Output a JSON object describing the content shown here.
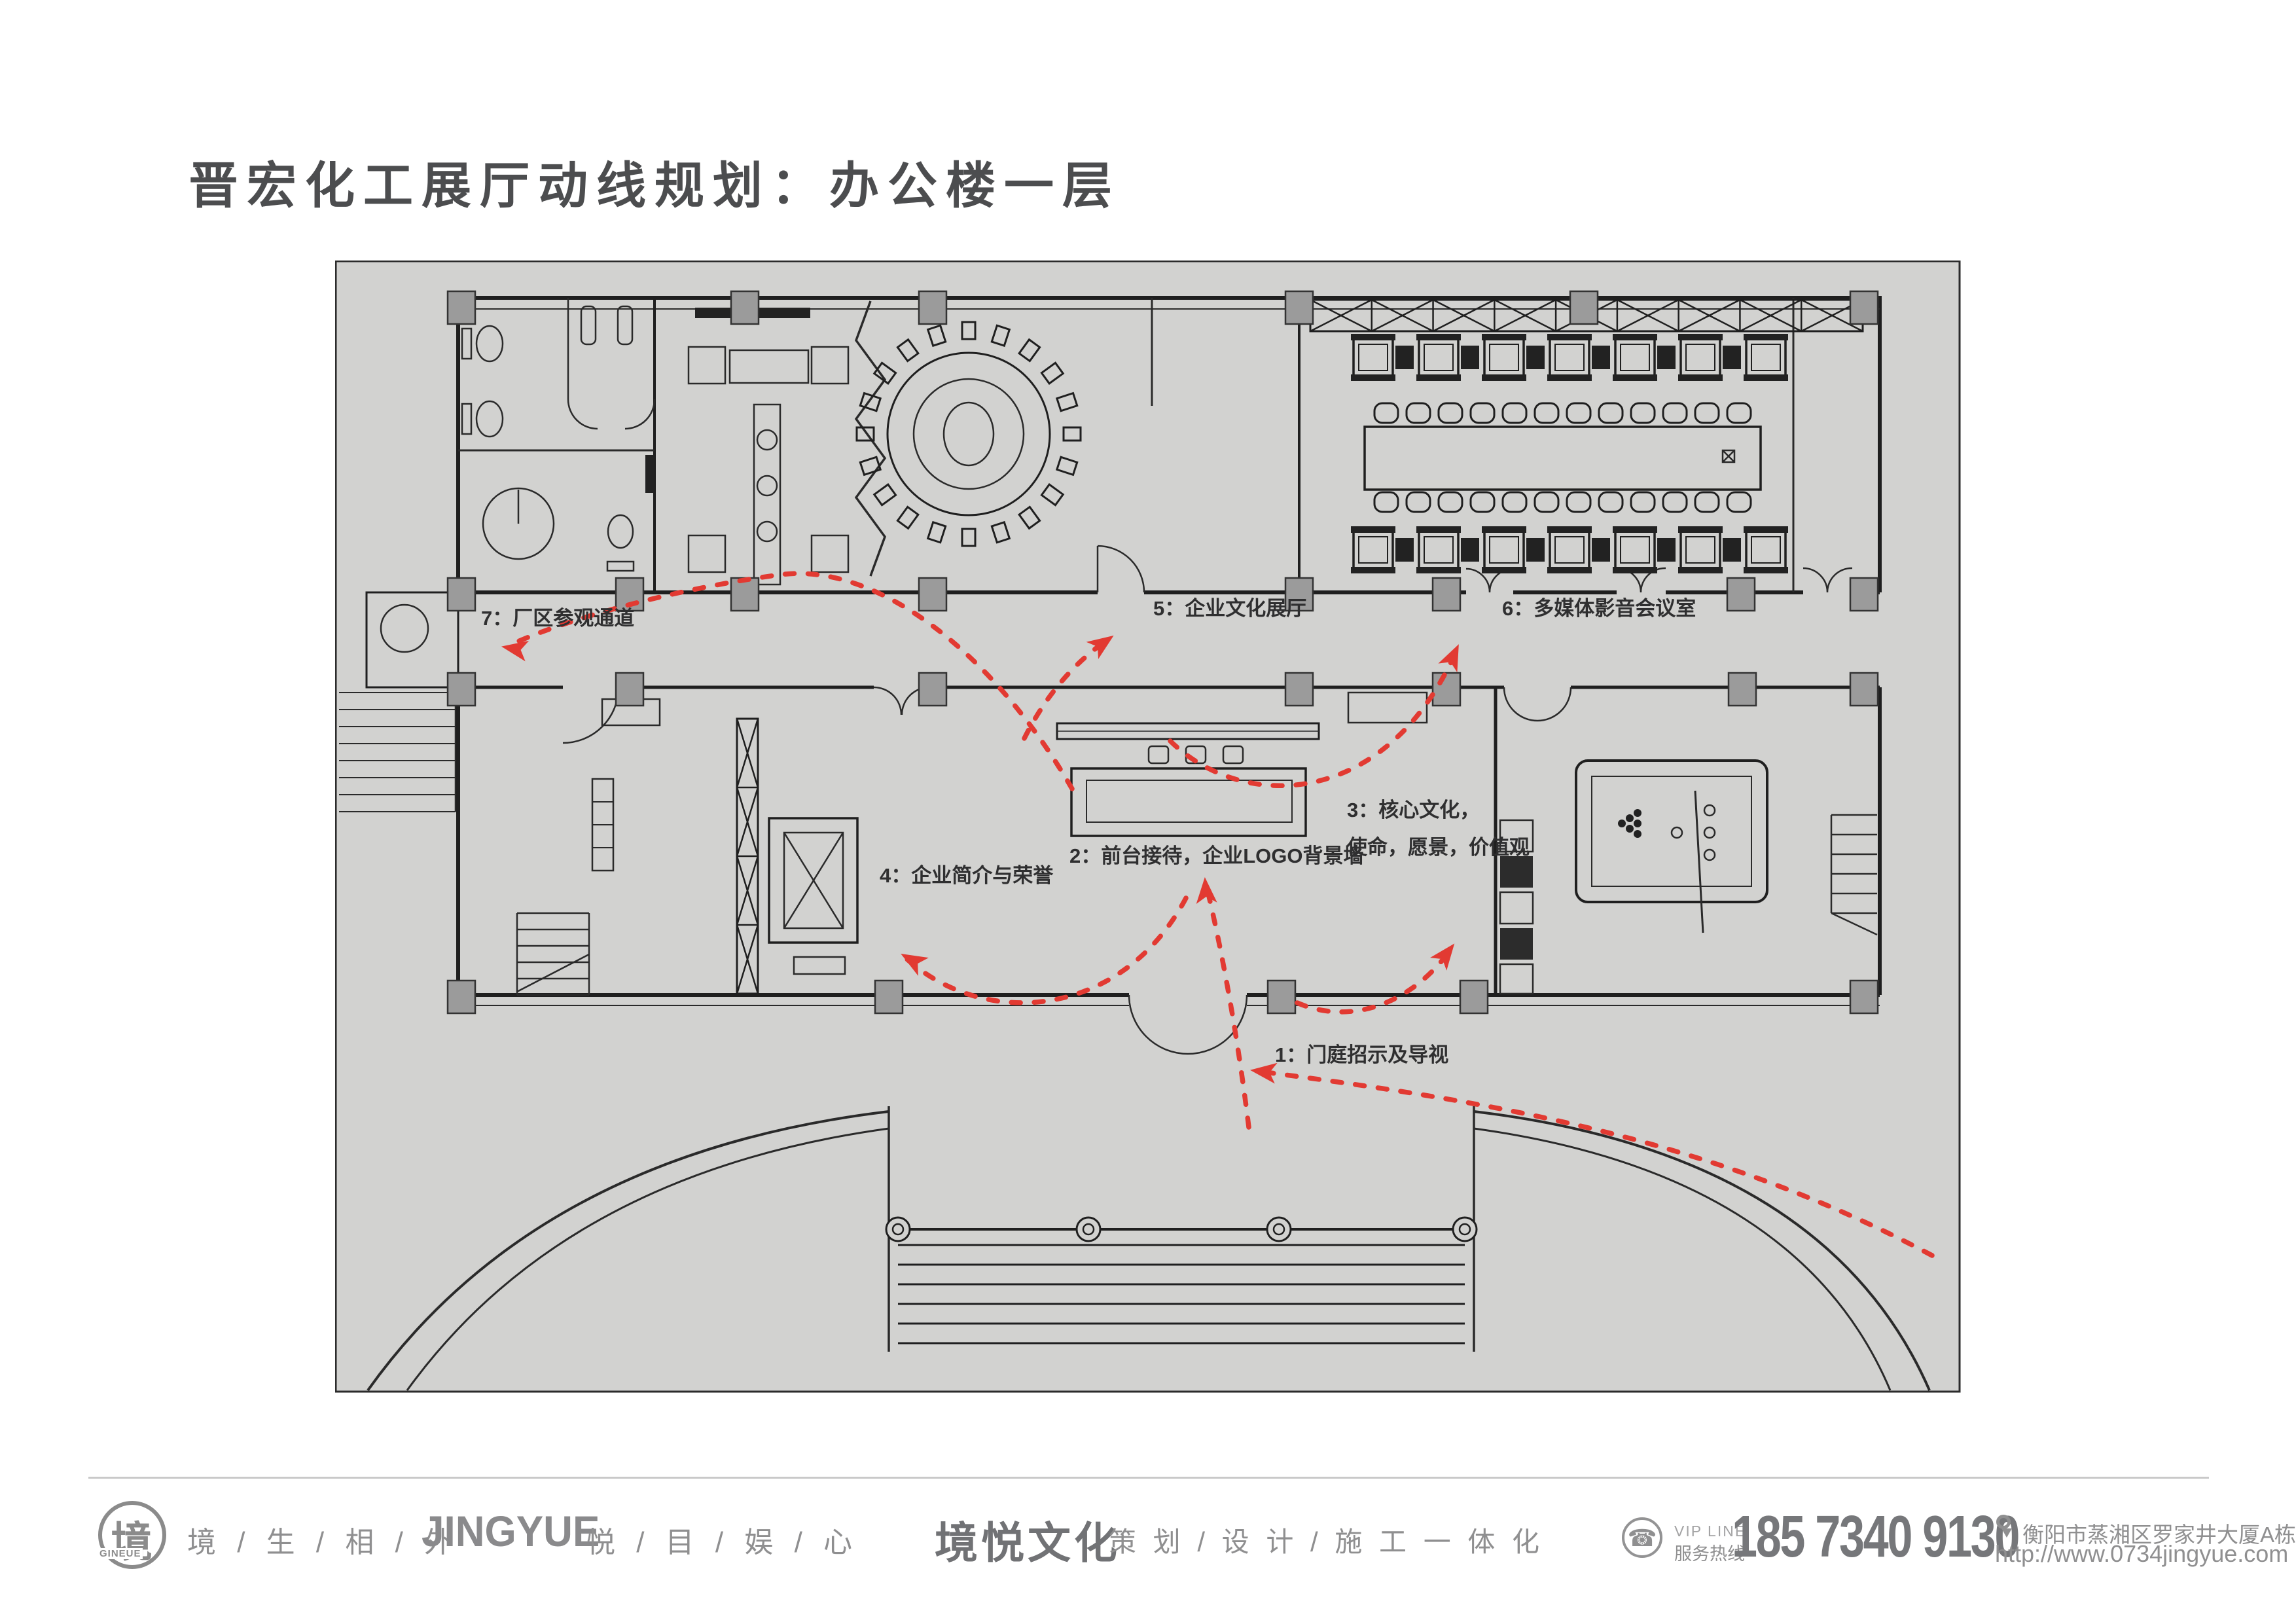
{
  "page": {
    "title": "晋宏化工展厅动线规划：办公楼一层"
  },
  "plan": {
    "labels": {
      "l1": "1：门庭招示及导视",
      "l2": "2：前台接待，企业LOGO背景墙",
      "l3_line1": "3：核心文化，",
      "l3_line2": "使命，愿景，价值观",
      "l4": "4：企业简介与荣誉",
      "l5": "5：企业文化展厅",
      "l6": "6：多媒体影音会议室",
      "l7": "7：厂区参观通道"
    },
    "colors": {
      "arrow_red": "#e23a32",
      "sheet_background": "#d2d2d0",
      "wall_line": "#1f1f1f",
      "column_fill": "#9b9b9b"
    }
  },
  "footer": {
    "logo_glyph": "境",
    "logo_sub": "GINEUE",
    "slogan_left": "境 / 生 / 相 / 外",
    "brand": "JINGYUE",
    "slogan_right": "悦 / 目 / 娱 / 心",
    "wordmark": "境悦文化",
    "services": "策 划 / 设 计 / 施 工 一 体 化",
    "phone_icon": "☎",
    "vip_line1": "VIP LINE",
    "vip_line2": "服务热线",
    "phone": "185 7340 9130",
    "address": "衡阳市蒸湘区罗家井大厦A栋",
    "website": "http://www.0734jingyue.com"
  }
}
